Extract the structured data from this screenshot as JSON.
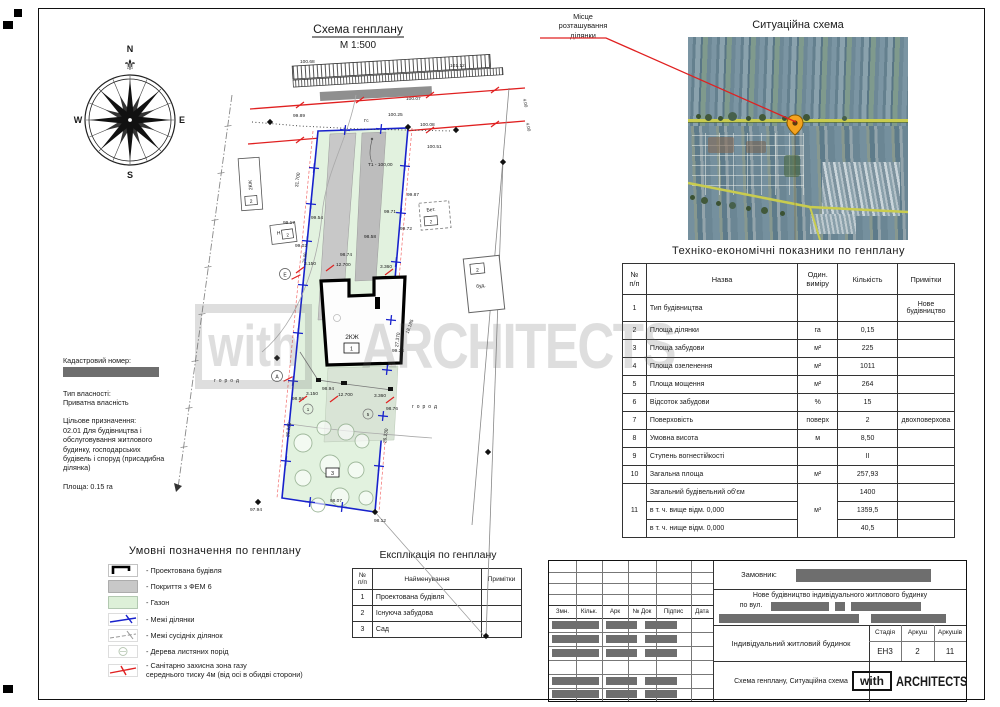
{
  "compass": {
    "n": "N",
    "e": "E",
    "s": "S",
    "w": "W"
  },
  "plan": {
    "title": "Схема генплану",
    "scale": "М 1:500",
    "gas_line_label": "Гс",
    "benchmark": "Т1 - 100,00",
    "building_label": "2КЖ",
    "building_ref": "1",
    "garden_ref": "3",
    "ref_1": "1",
    "ref_5": "5",
    "neighbor_house_left": "2КЖ",
    "neighbor_ref_left": "2",
    "shed_label": "Н",
    "shed_ref": "2",
    "axis_e": "Е",
    "axis_a": "А",
    "concrete_label": "Бет.",
    "concrete_ref": "2",
    "neighbor_house_right": "буд.",
    "neighbor_ref_right": "2",
    "garden_text_left": "город",
    "garden_text_right": "город",
    "elevations": {
      "e1": "100.68",
      "e2": "101.12",
      "e3": "100.07",
      "e4": "99.89",
      "e5": "100.25",
      "e6": "100.08",
      "e7": "100.51",
      "e8": "99.87",
      "e9": "99.71",
      "e10": "99.72",
      "e11": "99.54",
      "e12": "99.17",
      "e13": "99.02",
      "e14": "98.58",
      "e15": "98.74",
      "e16": "99.24",
      "e17": "98.94",
      "e18": "98.86",
      "e19": "98.76",
      "e20": "98.07",
      "e21": "97.94",
      "e22": "98.12"
    },
    "dimensions": {
      "left_top": "31.700",
      "left_bottom": "26.230",
      "right_top": "27.370",
      "right_bottom": "26.230",
      "depth": "75.00",
      "w1": "3.150",
      "w2": "12.700",
      "w3": "3.360",
      "w4": "3.150",
      "w5": "12.700",
      "w6": "3.360",
      "diag": "18.185",
      "gas1": "4.00",
      "gas2": "4.00"
    }
  },
  "situation": {
    "callout": "Місце\nрозташування\nділянки",
    "title": "Ситуаційна схема"
  },
  "info": {
    "cadastre_label": "Кадастровий номер:",
    "ownership_label": "Тип власності:",
    "ownership_value": "Приватна власність",
    "purpose_label": "Цільове призначення:",
    "purpose_value": "02.01 Для будівництва і обслуговування житлового будинку, господарських будівель і споруд (присадибна ділянка)",
    "area": "Площа: 0.15 га"
  },
  "teo": {
    "title": "Техніко-економічні показники по генплану",
    "headers": {
      "num": "№\nп/п",
      "name": "Назва",
      "unit": "Один.\nвиміру",
      "qty": "Кількість",
      "notes": "Примітки"
    },
    "rows": [
      {
        "num": "1",
        "name": "Тип будівництва",
        "unit": "",
        "qty": "",
        "notes": "Нове будівництво"
      },
      {
        "num": "2",
        "name": "Площа ділянки",
        "unit": "га",
        "qty": "0,15",
        "notes": ""
      },
      {
        "num": "3",
        "name": "Площа забудови",
        "unit": "м²",
        "qty": "225",
        "notes": ""
      },
      {
        "num": "4",
        "name": "Площа озеленення",
        "unit": "м²",
        "qty": "1011",
        "notes": ""
      },
      {
        "num": "5",
        "name": "Площа мощення",
        "unit": "м²",
        "qty": "264",
        "notes": ""
      },
      {
        "num": "6",
        "name": "Відсоток забудови",
        "unit": "%",
        "qty": "15",
        "notes": ""
      },
      {
        "num": "7",
        "name": "Поверховість",
        "unit": "поверх",
        "qty": "2",
        "notes": "двохповерхова"
      },
      {
        "num": "8",
        "name": "Умовна висота",
        "unit": "м",
        "qty": "8,50",
        "notes": ""
      },
      {
        "num": "9",
        "name": "Ступень вогнестійкості",
        "unit": "",
        "qty": "II",
        "notes": ""
      },
      {
        "num": "10",
        "name": "Загальна площа",
        "unit": "м²",
        "qty": "257,93",
        "notes": ""
      },
      {
        "num": "11",
        "name": "Загальний будівельний об'єм",
        "unit": "м³",
        "qty": "1400",
        "notes": ""
      },
      {
        "name": "в т. ч. вище відм. 0,000",
        "qty": "1359,5",
        "notes": ""
      },
      {
        "name": "в т. ч. нище відм. 0,000",
        "qty": "40,5",
        "notes": ""
      }
    ]
  },
  "legend": {
    "title": "Умовні позначення по генплану",
    "items": [
      {
        "symbol": "projected-building",
        "label": "- Проектована будівля"
      },
      {
        "symbol": "fem-paving",
        "label": "- Покриття з ФЕМ 6"
      },
      {
        "symbol": "lawn",
        "label": "- Газон"
      },
      {
        "symbol": "plot-boundary",
        "label": "- Межі ділянки"
      },
      {
        "symbol": "neighbor-boundary",
        "label": "- Межі сусідніх ділянок"
      },
      {
        "symbol": "deciduous-trees",
        "label": "- Дерева листяних порід"
      },
      {
        "symbol": "gas-zone",
        "label": "- Санітарно захисна зона газу\nсереднього тиску 4м (від осі в обидві сторони)"
      }
    ]
  },
  "explication": {
    "title": "Експлікація по генплану",
    "headers": {
      "num": "№\nп/п",
      "name": "Найменування",
      "notes": "Примітки"
    },
    "rows": [
      {
        "num": "1",
        "name": "Проектована будівля"
      },
      {
        "num": "2",
        "name": "Існуюча забудова"
      },
      {
        "num": "3",
        "name": "Сад"
      }
    ]
  },
  "titleblock": {
    "cols": [
      "Змн.",
      "Кільк.",
      "Арк",
      "№ Док",
      "Підпис",
      "Дата"
    ],
    "customer_label": "Замовник:",
    "project_line1": "Нове будівництво індивідуального житлового будинку",
    "project_line2_label": "по вул.",
    "object_name": "Індивідуальний житловий будинок",
    "stage_label": "Стадія",
    "sheet_label": "Аркуш",
    "sheets_label": "Аркушів",
    "stage": "ЕН3",
    "sheet": "2",
    "sheets": "11",
    "sheet_title": "Схема генплану, Ситуаційна схема",
    "logo_with": "with",
    "logo_architects": "ARCHITECTS"
  },
  "watermark": {
    "box": "with",
    "text": "ARCHITECTS"
  }
}
